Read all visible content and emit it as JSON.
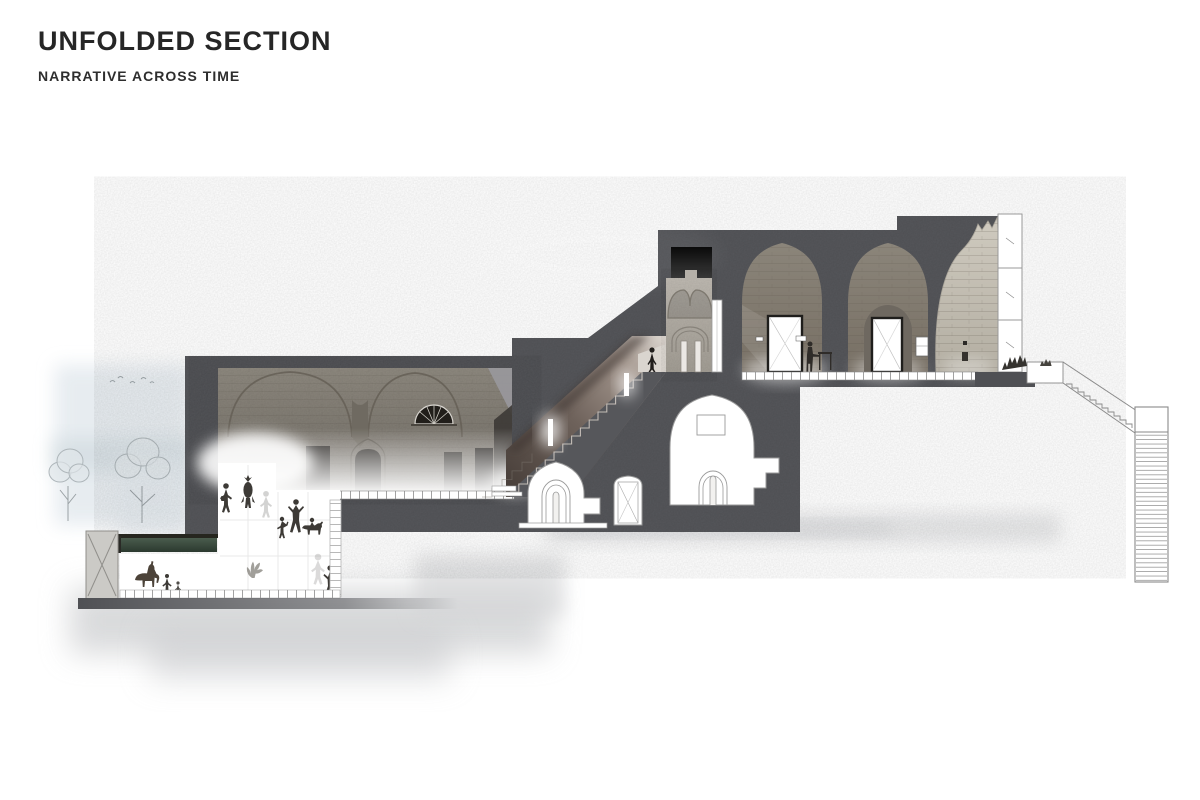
{
  "page": {
    "title": "UNFOLDED SECTION",
    "subtitle": "NARRATIVE ACROSS TIME"
  },
  "colors": {
    "ink": "#262626",
    "paper": "#ffffff",
    "poche": "#56575b",
    "ruin_stone": "#c9c4b9",
    "shaft_stone": "#b6b1a8",
    "green_roof": "#37493c",
    "wash_blue": "#e3e9ee",
    "ground_gray": "#d3d4d6",
    "outline_gray": "#8f8f8f",
    "figure_dark": "#3d3a36"
  }
}
